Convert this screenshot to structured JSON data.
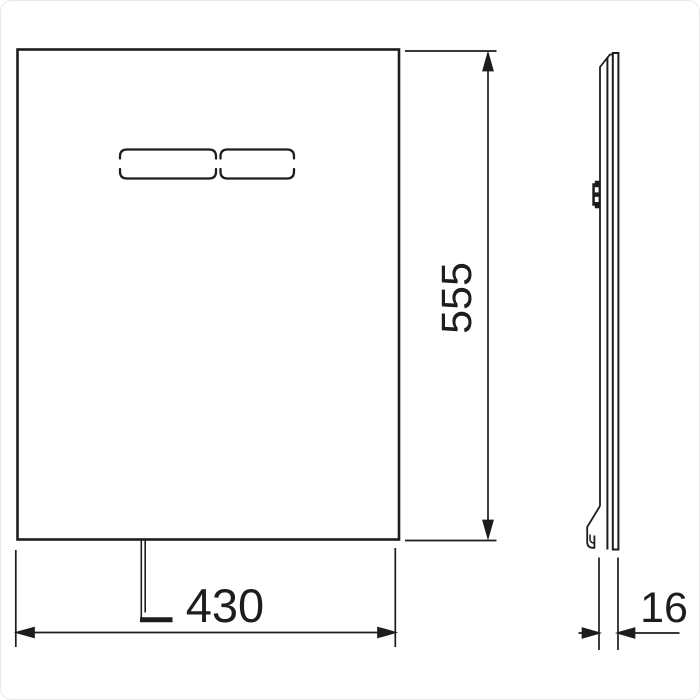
{
  "dimensions": {
    "width": "430",
    "height": "555",
    "depth": "16"
  },
  "colors": {
    "line": "#1d1d1b",
    "background": "#ffffff"
  }
}
